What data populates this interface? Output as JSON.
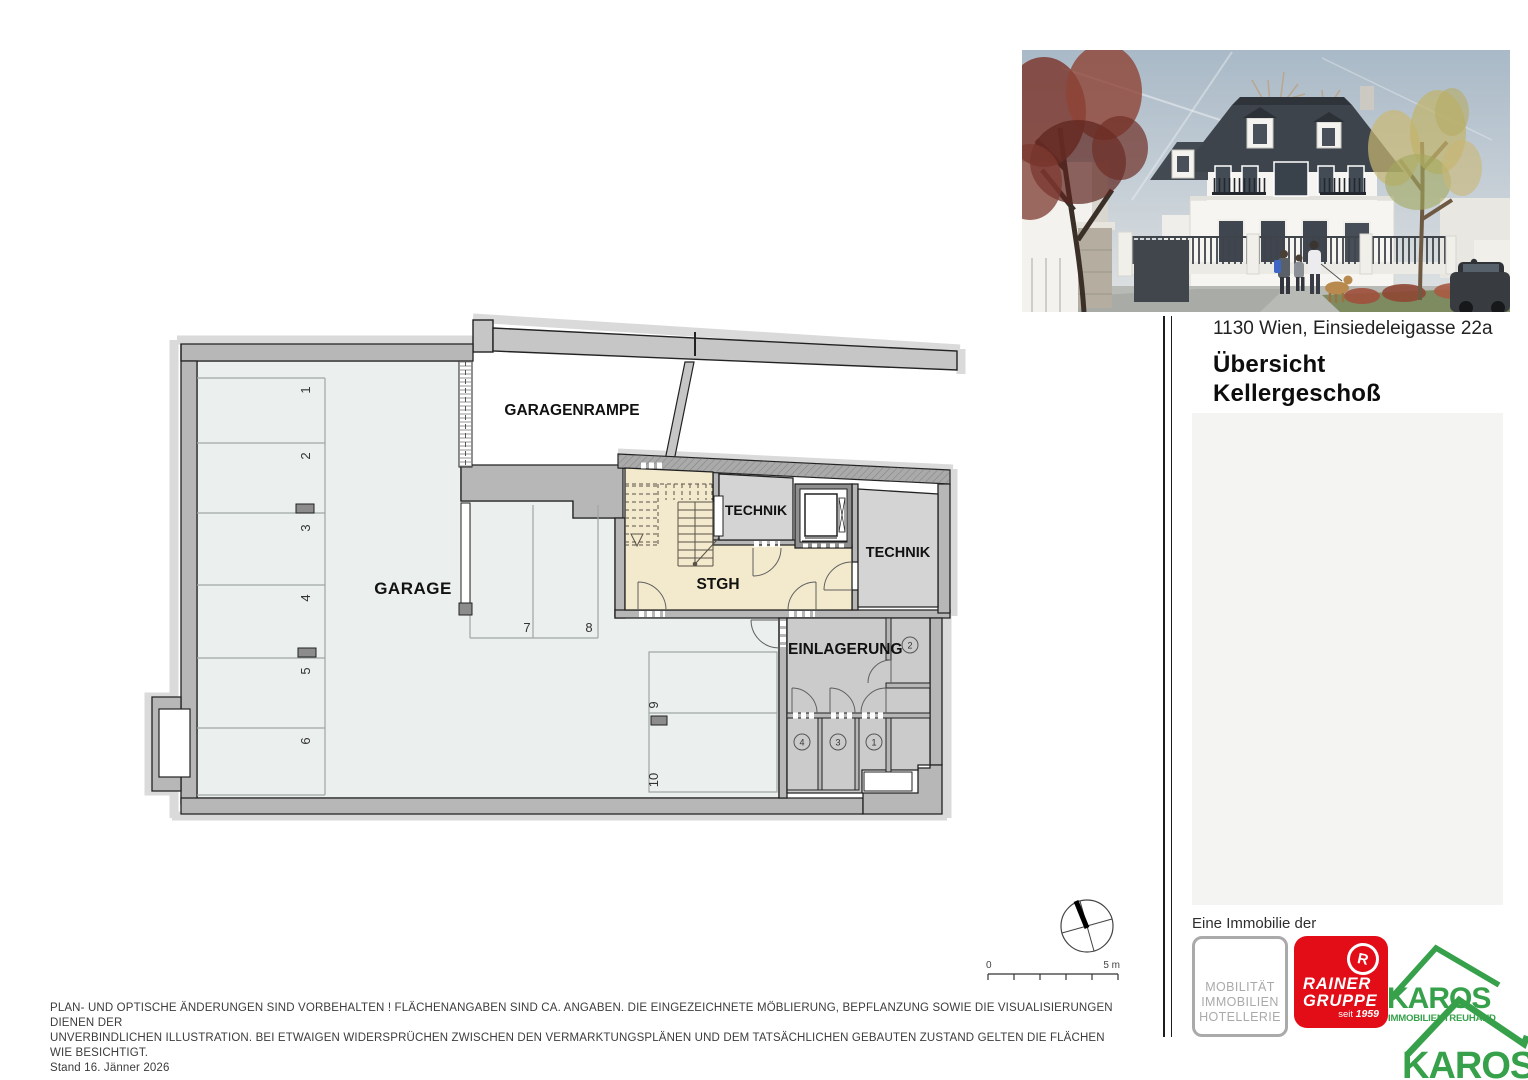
{
  "header": {
    "address": "1130 Wien, Einsiedeleigasse 22a",
    "title_line1": "Übersicht",
    "title_line2": "Kellergeschoß"
  },
  "plan": {
    "room_garage": "GARAGE",
    "room_ramp": "GARAGENRAMPE",
    "room_stairs": "STGH",
    "room_technik_small": "TECHNIK",
    "room_technik_large": "TECHNIK",
    "room_storage": "EINLAGERUNG",
    "parking": [
      "1",
      "2",
      "3",
      "4",
      "5",
      "6",
      "7",
      "8",
      "9",
      "10"
    ],
    "storage_units": [
      "1",
      "2",
      "3",
      "4"
    ],
    "scale_start": "0",
    "scale_end": "5 m"
  },
  "footer": {
    "line1": "PLAN- UND OPTISCHE ÄNDERUNGEN SIND VORBEHALTEN ! FLÄCHENANGABEN SIND CA. ANGABEN. DIE EINGEZEICHNETE MÖBLIERUNG, BEPFLANZUNG SOWIE DIE VISUALISIERUNGEN DIENEN DER",
    "line2": "UNVERBINDLICHEN ILLUSTRATION. BEI ETWAIGEN WIDERSPRÜCHEN ZWISCHEN DEN VERMARKTUNGSPLÄNEN UND DEM TATSÄCHLICHEN GEBAUTEN ZUSTAND GELTEN DIE FLÄCHEN WIE BESICHTIGT.",
    "line3": "Stand 16. Jänner 2026"
  },
  "branding": {
    "intro": "Eine Immobilie der",
    "mobilitaet_line1": "MOBILITÄT",
    "mobilitaet_line2": "IMMOBILIEN",
    "mobilitaet_line3": "HOTELLERIE",
    "rainer_r": "R",
    "rainer_line1": "RAINER",
    "rainer_line2": "GRUPPE",
    "rainer_seit": "seit ",
    "rainer_year": "1959",
    "karos_name": "KAROS",
    "karos_subtitle": "IMMOBILIENTREUHAND",
    "karos_name_2": "KAROS",
    "colors": {
      "rainer_red": "#e30d18",
      "karos_green": "#36a14a",
      "mobilitaet_gray": "#a9aaa9"
    }
  }
}
